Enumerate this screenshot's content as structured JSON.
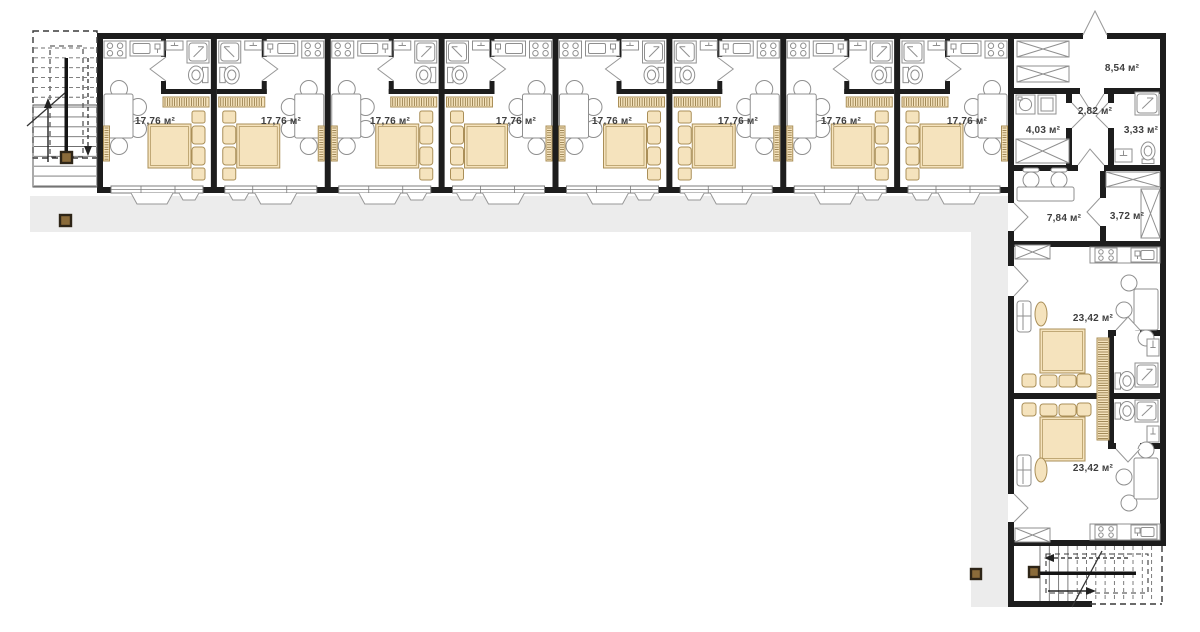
{
  "page": {
    "title": "Apartment floor plan"
  },
  "colors": {
    "wall": "#1d1d1d",
    "floor": "#ffffff",
    "corridor_floor": "#ececec",
    "furniture_line": "#8f8f8f",
    "window_line": "#7c7c7c",
    "door_line": "#979797",
    "tan_fill": "#f5e3bd",
    "tan_line": "#aa8f58",
    "hatch_line": "#8d7440",
    "stair_line": "#6f6f6f",
    "stair_dark": "#141414",
    "marker_fill": "#8a6b3a",
    "marker_border": "#2e2517",
    "label_color": "#3e3e3e"
  },
  "rooms": [
    {
      "name": "apartment-1",
      "label": "17,76 м²"
    },
    {
      "name": "apartment-2",
      "label": "17,76 м²"
    },
    {
      "name": "apartment-3",
      "label": "17,76 м²"
    },
    {
      "name": "apartment-4",
      "label": "17,76 м²"
    },
    {
      "name": "apartment-5",
      "label": "17,76 м²"
    },
    {
      "name": "apartment-6",
      "label": "17,76 м²"
    },
    {
      "name": "apartment-7",
      "label": "17,76 м²"
    },
    {
      "name": "apartment-8",
      "label": "17,76 м²"
    },
    {
      "name": "entrance-hall",
      "label": "8,54 м²"
    },
    {
      "name": "utility-room",
      "label": "4,03 м²"
    },
    {
      "name": "inner-corridor",
      "label": "2,82 м²"
    },
    {
      "name": "shared-bathroom",
      "label": "3,33 м²"
    },
    {
      "name": "office-room",
      "label": "7,84 м²"
    },
    {
      "name": "storage-room",
      "label": "3,72 м²"
    },
    {
      "name": "studio-1",
      "label": "23,42 м²"
    },
    {
      "name": "studio-2",
      "label": "23,42 м²"
    }
  ]
}
